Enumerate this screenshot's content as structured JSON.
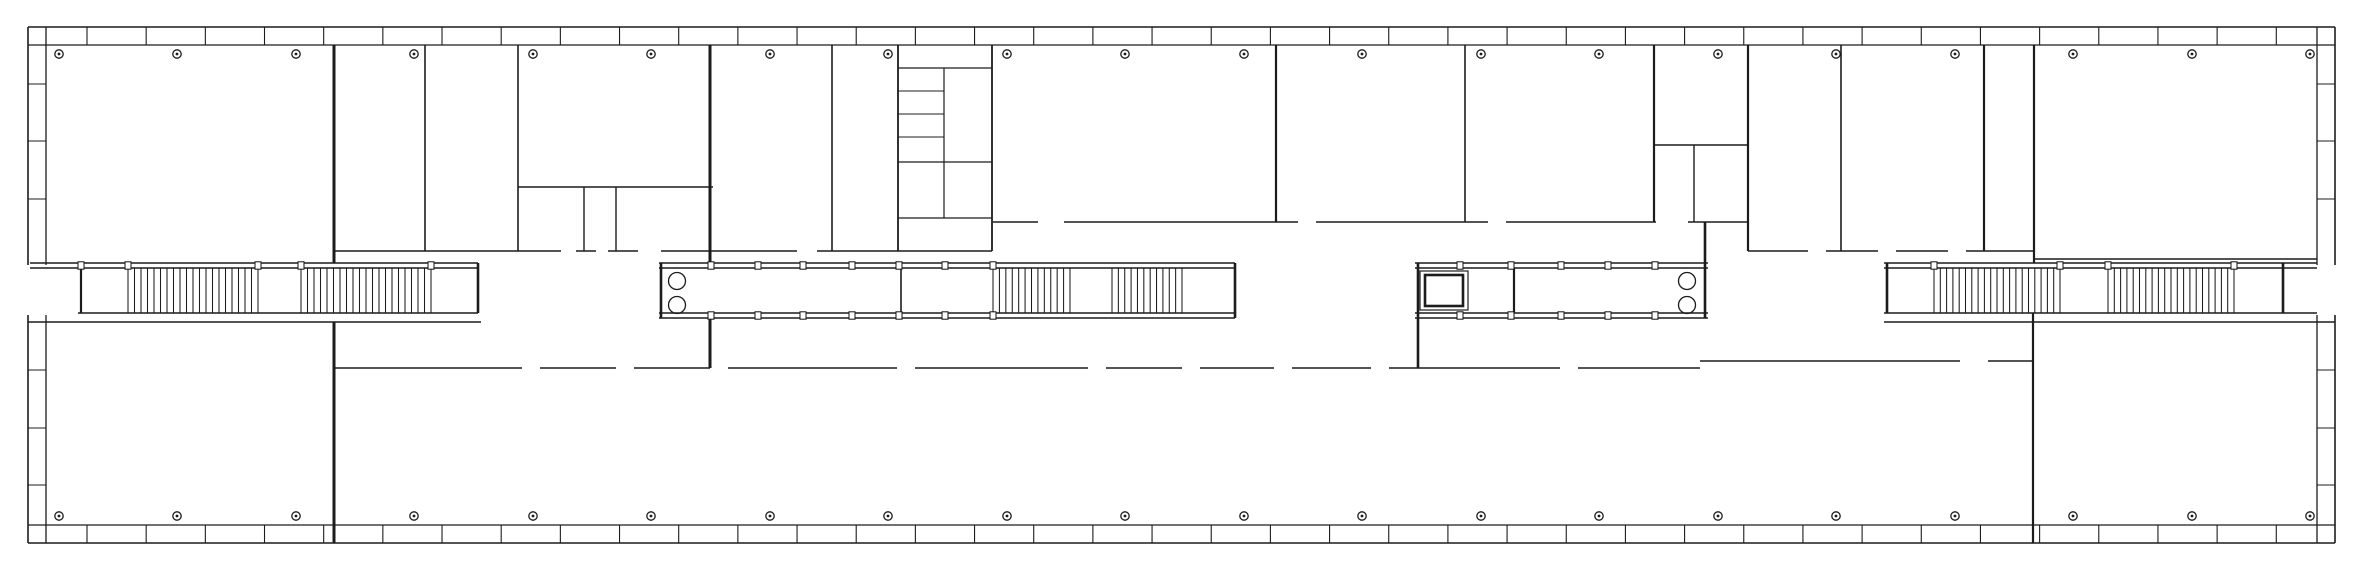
{
  "plan": {
    "width": 2363,
    "height": 571,
    "colors": {
      "ink": "#1c1c1c",
      "bg": "#ffffff"
    },
    "facades": [
      {
        "name": "top-facade",
        "orient": "h",
        "a1": 28,
        "a2": 2335,
        "lineOut": 27,
        "lineIn": 45,
        "tickFrom": 87,
        "tickStep": 59.17,
        "tickCount": 38,
        "gaps": []
      },
      {
        "name": "bottom-facade",
        "orient": "h",
        "a1": 28,
        "a2": 2335,
        "lineOut": 543,
        "lineIn": 525,
        "tickFrom": 87,
        "tickStep": 59.17,
        "tickCount": 38,
        "gaps": []
      },
      {
        "name": "left-facade",
        "orient": "v",
        "a1": 27,
        "a2": 543,
        "lineOut": 28,
        "lineIn": 46,
        "ticks": [
          84,
          141,
          199,
          370,
          428,
          485
        ],
        "gaps": [
          [
            265,
            315
          ]
        ]
      },
      {
        "name": "right-facade",
        "orient": "v",
        "a1": 27,
        "a2": 543,
        "lineOut": 2335,
        "lineIn": 2317,
        "ticks": [
          84,
          141,
          199,
          370,
          428,
          485
        ],
        "gaps": [
          [
            265,
            315
          ]
        ]
      }
    ],
    "columns": {
      "xs": [
        59,
        177,
        296,
        414,
        533,
        651,
        770,
        888,
        1007,
        1125,
        1244,
        1362,
        1481,
        1599,
        1718,
        1836,
        1955,
        2073,
        2192,
        2310
      ],
      "rows": [
        54,
        516
      ],
      "r": 4.2,
      "dotR": 1.4
    },
    "wallsH": [
      {
        "y": 263,
        "w": 1.4,
        "segs": [
          [
            30,
            478
          ],
          [
            659,
            1235
          ],
          [
            1415,
            1708
          ],
          [
            1884,
            2317
          ]
        ]
      },
      {
        "y": 268,
        "w": 1.4,
        "segs": [
          [
            30,
            478
          ],
          [
            659,
            1235
          ],
          [
            1415,
            1708
          ],
          [
            1884,
            2317
          ]
        ]
      },
      {
        "y": 313,
        "w": 1.4,
        "segs": [
          [
            78,
            478
          ],
          [
            659,
            1235
          ],
          [
            1415,
            1708
          ],
          [
            1884,
            2317
          ]
        ]
      },
      {
        "y": 318,
        "w": 1.4,
        "segs": [
          [
            659,
            1235
          ],
          [
            1415,
            1708
          ]
        ]
      },
      {
        "y": 322,
        "w": 1.4,
        "segs": [
          [
            28,
            481
          ],
          [
            1884,
            2335
          ]
        ]
      },
      {
        "y": 251,
        "w": 1.6,
        "segs": [
          [
            334,
            561
          ],
          [
            576,
            596
          ],
          [
            608,
            638
          ],
          [
            661,
            797
          ],
          [
            817,
            992
          ],
          [
            1748,
            1808
          ],
          [
            1826,
            1878
          ],
          [
            1896,
            1948
          ],
          [
            1966,
            2034
          ]
        ]
      },
      {
        "y": 218,
        "w": 1.2,
        "segs": [
          [
            898,
            992
          ]
        ]
      },
      {
        "y": 222,
        "w": 1.6,
        "segs": [
          [
            993,
            1038
          ],
          [
            1064,
            1298
          ],
          [
            1316,
            1488
          ],
          [
            1506,
            1656
          ],
          [
            1688,
            1748
          ]
        ]
      },
      {
        "y": 259,
        "w": 1.4,
        "segs": [
          [
            2035,
            2317
          ]
        ]
      },
      {
        "y": 187,
        "w": 1.4,
        "segs": [
          [
            518,
            713
          ]
        ]
      },
      {
        "y": 145,
        "w": 1.4,
        "segs": [
          [
            1655,
            1748
          ]
        ]
      },
      {
        "y": 68,
        "w": 1.2,
        "segs": [
          [
            898,
            992
          ]
        ]
      },
      {
        "y": 162,
        "w": 1.2,
        "segs": [
          [
            898,
            992
          ]
        ]
      },
      {
        "y": 91,
        "w": 1.1,
        "segs": [
          [
            898,
            944
          ]
        ]
      },
      {
        "y": 114,
        "w": 1.1,
        "segs": [
          [
            898,
            944
          ]
        ]
      },
      {
        "y": 137,
        "w": 1.1,
        "segs": [
          [
            898,
            944
          ]
        ]
      },
      {
        "y": 368,
        "w": 1.6,
        "segs": [
          [
            334,
            522
          ],
          [
            540,
            616
          ],
          [
            634,
            710
          ],
          [
            728,
            897
          ],
          [
            915,
            1088
          ],
          [
            1106,
            1182
          ],
          [
            1200,
            1274
          ],
          [
            1292,
            1371
          ],
          [
            1389,
            1560
          ],
          [
            1578,
            1700
          ]
        ]
      },
      {
        "y": 361,
        "w": 1.6,
        "segs": [
          [
            1700,
            1960
          ],
          [
            1988,
            2033
          ]
        ]
      }
    ],
    "wallsV": [
      {
        "x": 334,
        "w": 3.0,
        "segs": [
          [
            45,
            263
          ],
          [
            322,
            543
          ]
        ]
      },
      {
        "x": 425,
        "w": 1.6,
        "segs": [
          [
            45,
            251
          ]
        ]
      },
      {
        "x": 518,
        "w": 1.6,
        "segs": [
          [
            45,
            251
          ]
        ]
      },
      {
        "x": 584,
        "w": 1.4,
        "segs": [
          [
            187,
            251
          ]
        ]
      },
      {
        "x": 616,
        "w": 1.4,
        "segs": [
          [
            187,
            251
          ]
        ]
      },
      {
        "x": 710,
        "w": 3.0,
        "segs": [
          [
            45,
            263
          ],
          [
            318,
            368
          ]
        ]
      },
      {
        "x": 832,
        "w": 1.6,
        "segs": [
          [
            45,
            251
          ]
        ]
      },
      {
        "x": 898,
        "w": 1.8,
        "segs": [
          [
            45,
            251
          ]
        ]
      },
      {
        "x": 944,
        "w": 1.2,
        "segs": [
          [
            68,
            218
          ]
        ]
      },
      {
        "x": 992,
        "w": 1.8,
        "segs": [
          [
            45,
            251
          ]
        ]
      },
      {
        "x": 1276,
        "w": 2.2,
        "segs": [
          [
            45,
            222
          ]
        ]
      },
      {
        "x": 1465,
        "w": 1.6,
        "segs": [
          [
            45,
            222
          ]
        ]
      },
      {
        "x": 1654,
        "w": 2.2,
        "segs": [
          [
            45,
            222
          ]
        ]
      },
      {
        "x": 1694,
        "w": 1.4,
        "segs": [
          [
            145,
            222
          ]
        ]
      },
      {
        "x": 1748,
        "w": 2.2,
        "segs": [
          [
            45,
            251
          ]
        ]
      },
      {
        "x": 1841,
        "w": 1.6,
        "segs": [
          [
            45,
            251
          ]
        ]
      },
      {
        "x": 1984,
        "w": 2.2,
        "segs": [
          [
            45,
            251
          ]
        ]
      },
      {
        "x": 2034,
        "w": 2.2,
        "segs": [
          [
            45,
            263
          ]
        ]
      },
      {
        "x": 2033,
        "w": 2.2,
        "segs": [
          [
            313,
            543
          ]
        ]
      },
      {
        "x": 81,
        "w": 2.2,
        "segs": [
          [
            268,
            313
          ]
        ]
      },
      {
        "x": 478,
        "w": 2.6,
        "segs": [
          [
            263,
            313
          ]
        ]
      },
      {
        "x": 661,
        "w": 2.6,
        "segs": [
          [
            263,
            318
          ]
        ]
      },
      {
        "x": 901,
        "w": 1.6,
        "segs": [
          [
            268,
            313
          ]
        ]
      },
      {
        "x": 1235,
        "w": 2.6,
        "segs": [
          [
            263,
            318
          ]
        ]
      },
      {
        "x": 1418,
        "w": 2.6,
        "segs": [
          [
            263,
            368
          ]
        ]
      },
      {
        "x": 1514,
        "w": 2.2,
        "segs": [
          [
            268,
            313
          ]
        ]
      },
      {
        "x": 1705,
        "w": 2.6,
        "segs": [
          [
            222,
            318
          ]
        ]
      },
      {
        "x": 1887,
        "w": 2.6,
        "segs": [
          [
            263,
            313
          ]
        ]
      },
      {
        "x": 2283,
        "w": 2.6,
        "segs": [
          [
            263,
            313
          ]
        ]
      }
    ],
    "stairRuns": [
      {
        "name": "stair-west-run-1",
        "x1": 128,
        "x2": 258,
        "y1": 268,
        "y2": 313,
        "lines": 21
      },
      {
        "name": "stair-west-run-2",
        "x1": 301,
        "x2": 431,
        "y1": 268,
        "y2": 313,
        "lines": 21
      },
      {
        "name": "stair-center-run-1",
        "x1": 993,
        "x2": 1070,
        "y1": 268,
        "y2": 313,
        "lines": 13
      },
      {
        "name": "stair-center-run-2",
        "x1": 1112,
        "x2": 1182,
        "y1": 268,
        "y2": 313,
        "lines": 12
      },
      {
        "name": "stair-east-run-1",
        "x1": 1934,
        "x2": 2060,
        "y1": 268,
        "y2": 313,
        "lines": 21
      },
      {
        "name": "stair-east-run-2",
        "x1": 2108,
        "x2": 2234,
        "y1": 268,
        "y2": 313,
        "lines": 21
      }
    ],
    "stripTicks": [
      {
        "bands": [
          [
            263,
            268
          ],
          [
            313,
            318
          ]
        ],
        "xs": [
          711,
          758,
          803,
          852,
          899,
          945,
          993,
          1460,
          1511,
          1561,
          1608,
          1655
        ]
      },
      {
        "bands": [
          [
            263,
            268
          ]
        ],
        "xs": [
          81,
          128,
          258,
          301,
          431,
          1934,
          2060,
          2108,
          2234
        ]
      }
    ],
    "fixtures": {
      "wcCircles": [
        {
          "cx": 677,
          "cy": 281,
          "r": 8.5
        },
        {
          "cx": 677,
          "cy": 305,
          "r": 8.5
        },
        {
          "cx": 1687,
          "cy": 281,
          "r": 8.5
        },
        {
          "cx": 1687,
          "cy": 305,
          "r": 8.5
        }
      ],
      "elevator": {
        "outer": {
          "x": 1420,
          "y": 271,
          "w": 48,
          "h": 39,
          "stroke": 1.2
        },
        "inner": {
          "x": 1425,
          "y": 275,
          "w": 38,
          "h": 31,
          "stroke": 2.6
        }
      }
    }
  }
}
